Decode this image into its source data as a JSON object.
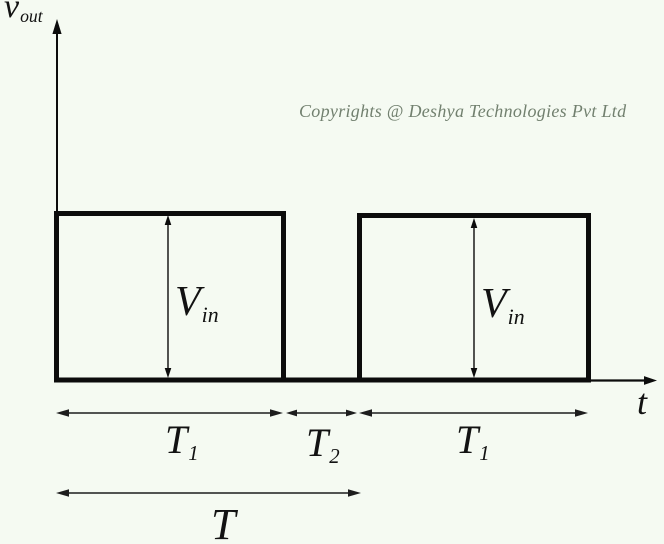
{
  "figure": {
    "copyright": "Copyrights @ Deshya Technologies Pvt Ltd"
  },
  "labels": {
    "y_axis": {
      "main": "v",
      "sub": "out"
    },
    "x_axis": "t",
    "amplitude1": {
      "main": "V",
      "sub": "in"
    },
    "amplitude2": {
      "main": "V",
      "sub": "in"
    },
    "interval_t1_first": {
      "main": "T",
      "sub": "1"
    },
    "interval_t2": {
      "main": "T",
      "sub": "2"
    },
    "interval_t1_second": {
      "main": "T",
      "sub": "1"
    },
    "period": "T"
  },
  "waveform": {
    "type": "pulse-train",
    "amplitude_label": "V_in",
    "on_time_label": "T1",
    "off_time_label": "T2",
    "period_label": "T",
    "pulses_shown": 2,
    "description": "Output voltage v_out vs t: rectangular pulses of height V_in lasting T1, off for T2, repeating with period T"
  },
  "colors": {
    "bg": "#f5faf2",
    "ink": "#0c0c0c",
    "dim": "#1d1d1d",
    "muted": "#72806f",
    "label": "#121212"
  }
}
